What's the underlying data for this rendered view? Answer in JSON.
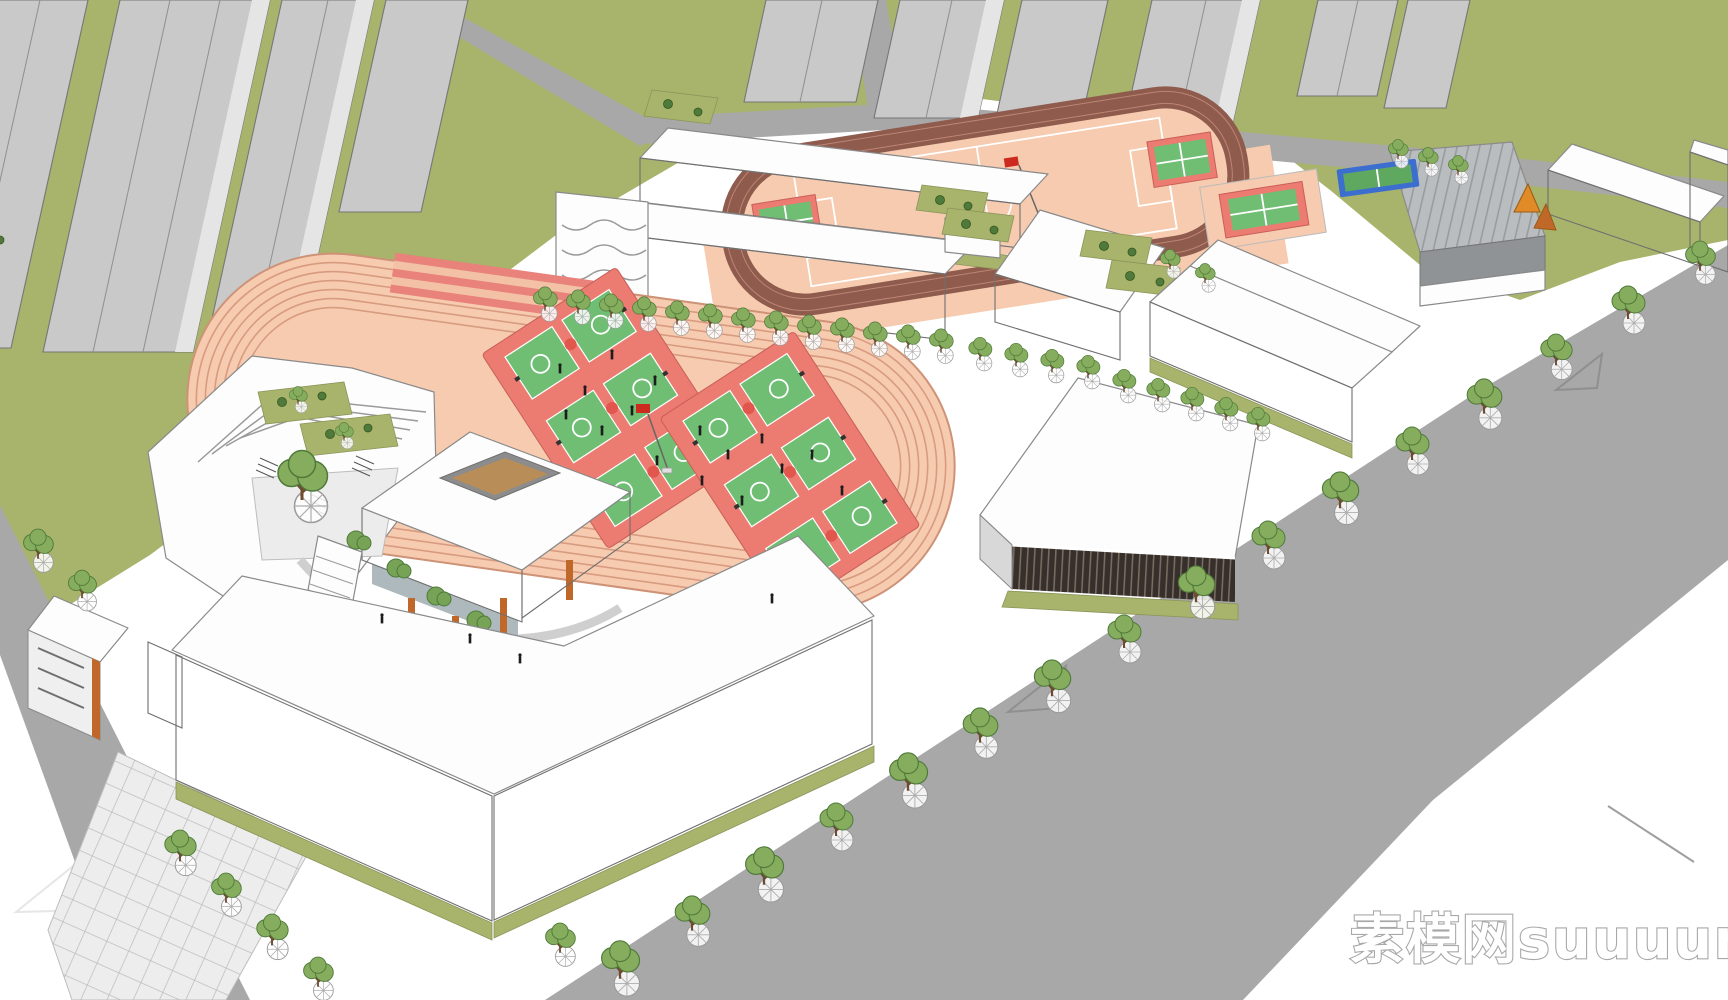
{
  "watermark": {
    "text": "素模网suuuum.com",
    "text_cn": "素模网",
    "text_latin": "suuuum.com"
  },
  "scene": {
    "type": "3d-architectural-rendering",
    "subject": "Aerial axonometric view of a school campus model surrounded by city roads and grey high-rise towers",
    "features": [
      {
        "name": "running-track",
        "description": "large oval running track with salmon lanes"
      },
      {
        "name": "basketball-courts",
        "description": "six green basketball courts on two red pads inside the track"
      },
      {
        "name": "soccer-field",
        "description": "upper track ring with salmon soccer field, white markings and red flag"
      },
      {
        "name": "classroom-buildings",
        "description": "white multi-storey slab buildings with dark window bands and roof gardens"
      },
      {
        "name": "gymnasium",
        "description": "wedge-shaped sports hall with white roof and dark louvered facade"
      },
      {
        "name": "metal-roof-hall",
        "description": "hall with grey ribbed metal roof"
      },
      {
        "name": "library-pavilion",
        "description": "cubic pavilion with wooden louvers and a square roof courtyard"
      },
      {
        "name": "terraced-building",
        "description": "stepped terraced building with roof gardens and courtyard"
      },
      {
        "name": "high-rise-towers",
        "description": "surrounding grey residential tower masses on grass"
      },
      {
        "name": "street-trees",
        "description": "rows of street trees along the perimeter roads"
      },
      {
        "name": "tennis-court",
        "description": "small blue and green court strip near the north-east hall"
      },
      {
        "name": "flag",
        "description": "red flags on poles at the sports grounds"
      }
    ]
  },
  "colors": {
    "grass": "#A8B36B",
    "road": "#A8A8A8",
    "sidewalk": "#FFFFFF",
    "track": "#F6CBB0",
    "track_lane": "#D89B80",
    "track_ring_dark": "#8E5B4D",
    "court_green": "#6FBE74",
    "court_red": "#EC7B72",
    "court_center_red": "#E2574D",
    "building_white": "#FDFDFD",
    "window_band": "#4E4E4E",
    "glass": "#CBD9E1",
    "wood": "#C0682A",
    "wood_dark": "#B5621F",
    "gym_slats": "#362F2B",
    "metal_roof": "#B9BDBF",
    "tower_gray": "#C9C9C9",
    "tree_canopy": "#86AC5D",
    "tree_outline": "#4E7A3A",
    "bush_green": "#77A356",
    "flag_red": "#CC2A1E",
    "tennis_blue": "#3C6ED0",
    "tennis_green": "#5FA85F",
    "watermark_fill": "#FFFFFF",
    "watermark_outline": "#A8A8A8"
  }
}
